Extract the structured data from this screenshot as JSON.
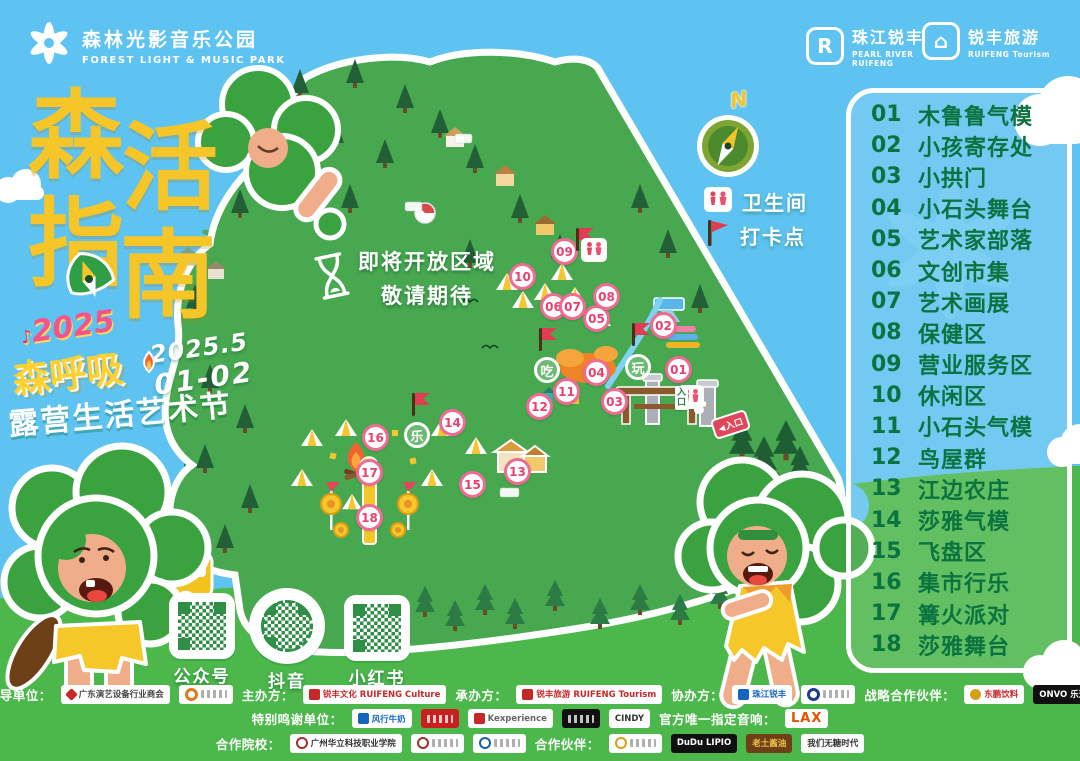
{
  "colors": {
    "sky": "#5ec3f1",
    "grass": "#4cb74b",
    "title_yellow": "#f6c629",
    "legend_green": "#0a7340",
    "marker_pink": "#e8537c"
  },
  "header": {
    "park_logo": {
      "title": "森林光影音乐公园",
      "subtitle": "FOREST LIGHT & MUSIC PARK"
    },
    "brand1": {
      "name": "珠江锐丰",
      "line1": "PEARL RIVER",
      "line2": "RUIFENG"
    },
    "brand2": {
      "name": "锐丰旅游",
      "line1": "RUIFENG Tourism"
    }
  },
  "title_block": {
    "char1": "森",
    "char2": "活",
    "char3": "指",
    "char4": "南",
    "festival_logo": "2025",
    "event_name": "森呼吸",
    "date_top": "2025.5",
    "date_bottom": "01-02",
    "subtitle": "露营生活艺术节"
  },
  "map": {
    "coming_soon_line1": "即将开放区域",
    "coming_soon_line2": "敬请期待",
    "compass_n": "N",
    "map_legend": [
      {
        "icon": "restroom-icon",
        "label": "卫生间"
      },
      {
        "icon": "flag-icon",
        "label": "打卡点"
      }
    ],
    "entrance_sign": "入口",
    "entrance_arrow": "入口",
    "markers": [
      {
        "n": "01",
        "x": 679,
        "y": 370
      },
      {
        "n": "02",
        "x": 664,
        "y": 326
      },
      {
        "n": "03",
        "x": 615,
        "y": 402
      },
      {
        "n": "04",
        "x": 597,
        "y": 373
      },
      {
        "n": "05",
        "x": 597,
        "y": 319
      },
      {
        "n": "06",
        "x": 554,
        "y": 307
      },
      {
        "n": "07",
        "x": 573,
        "y": 307
      },
      {
        "n": "08",
        "x": 607,
        "y": 297
      },
      {
        "n": "09",
        "x": 565,
        "y": 252
      },
      {
        "n": "10",
        "x": 523,
        "y": 277
      },
      {
        "n": "11",
        "x": 567,
        "y": 392
      },
      {
        "n": "12",
        "x": 540,
        "y": 407
      },
      {
        "n": "13",
        "x": 518,
        "y": 472
      },
      {
        "n": "14",
        "x": 453,
        "y": 423
      },
      {
        "n": "15",
        "x": 473,
        "y": 485
      },
      {
        "n": "16",
        "x": 376,
        "y": 438
      },
      {
        "n": "17",
        "x": 370,
        "y": 473
      },
      {
        "n": "18",
        "x": 370,
        "y": 518
      }
    ],
    "badges": [
      {
        "ch": "吃",
        "x": 547,
        "y": 370
      },
      {
        "ch": "玩",
        "x": 638,
        "y": 367
      },
      {
        "ch": "乐",
        "x": 417,
        "y": 435
      }
    ],
    "flags": [
      {
        "x": 577,
        "y": 248
      },
      {
        "x": 633,
        "y": 343
      },
      {
        "x": 540,
        "y": 348
      },
      {
        "x": 413,
        "y": 413
      }
    ],
    "wc": [
      {
        "x": 594,
        "y": 250
      },
      {
        "x": 691,
        "y": 397
      }
    ]
  },
  "legend_panel": {
    "items": [
      {
        "num": "01",
        "label": "木鲁鲁气模"
      },
      {
        "num": "02",
        "label": "小孩寄存处"
      },
      {
        "num": "03",
        "label": "小拱门"
      },
      {
        "num": "04",
        "label": "小石头舞台"
      },
      {
        "num": "05",
        "label": "艺术家部落"
      },
      {
        "num": "06",
        "label": "文创市集"
      },
      {
        "num": "07",
        "label": "艺术画展"
      },
      {
        "num": "08",
        "label": "保健区"
      },
      {
        "num": "09",
        "label": "营业服务区"
      },
      {
        "num": "10",
        "label": "休闲区"
      },
      {
        "num": "11",
        "label": "小石头气模"
      },
      {
        "num": "12",
        "label": "鸟屋群"
      },
      {
        "num": "13",
        "label": "江边农庄"
      },
      {
        "num": "14",
        "label": "莎雅气模"
      },
      {
        "num": "15",
        "label": "飞盘区"
      },
      {
        "num": "16",
        "label": "集市行乐"
      },
      {
        "num": "17",
        "label": "篝火派对"
      },
      {
        "num": "18",
        "label": "莎雅舞台"
      }
    ]
  },
  "qr": {
    "items": [
      {
        "label": "公众号"
      },
      {
        "label": "抖音"
      },
      {
        "label": "小红书"
      }
    ]
  },
  "sponsors": {
    "rows": [
      {
        "groups": [
          {
            "label": "指导单位：",
            "logos": [
              {
                "t": "广东演艺设备行业商会",
                "c": "",
                "i": "red-diamond"
              },
              {
                "t": "",
                "c": "pill-ghost",
                "i": "orange-ring"
              }
            ]
          },
          {
            "label": "主办方：",
            "logos": [
              {
                "t": "锐丰文化 RUIFENG Culture",
                "c": "txt-red",
                "i": "red-square"
              }
            ]
          },
          {
            "label": "承办方：",
            "logos": [
              {
                "t": "锐丰旅游 RUIFENG Tourism",
                "c": "txt-red",
                "i": "red-square"
              }
            ]
          },
          {
            "label": "协办方：",
            "logos": [
              {
                "t": "珠江锐丰",
                "c": "txt-blue",
                "i": "blue-r"
              },
              {
                "t": "",
                "c": "pill-ghost",
                "i": "blue-ring"
              }
            ]
          },
          {
            "label": "战略合作伙伴：",
            "logos": [
              {
                "t": "东鹏饮料",
                "c": "txt-red",
                "i": "gold-badge"
              },
              {
                "t": "ONVO 乐道",
                "c": "pill-black",
                "i": ""
              }
            ]
          }
        ]
      },
      {
        "groups": [
          {
            "label": "特别鸣谢单位：",
            "logos": [
              {
                "t": "风行牛奶",
                "c": "txt-blue",
                "i": "blue-box"
              },
              {
                "t": "",
                "c": "pill-red pill-ghost",
                "i": ""
              },
              {
                "t": "Kexperience",
                "c": "txt-gray",
                "i": "red-r"
              },
              {
                "t": "",
                "c": "pill-black pill-ghost",
                "i": ""
              },
              {
                "t": "CINDY",
                "c": "txt-dark",
                "i": ""
              }
            ]
          },
          {
            "label": "官方唯一指定音响：",
            "logos": [
              {
                "t": "LAX",
                "c": "txt-lax",
                "i": ""
              }
            ]
          }
        ]
      },
      {
        "groups": [
          {
            "label": "合作院校：",
            "logos": [
              {
                "t": "广州华立科技职业学院",
                "c": "txt-dark",
                "i": "crest-red"
              },
              {
                "t": "",
                "c": "pill-ghost",
                "i": "crest-red"
              },
              {
                "t": "",
                "c": "pill-ghost",
                "i": "crest-blue"
              }
            ]
          },
          {
            "label": "合作伙伴：",
            "logos": [
              {
                "t": "",
                "c": "pill-ghost",
                "i": "gold-ring"
              },
              {
                "t": "DuDu LIPIO",
                "c": "pill-black",
                "i": ""
              },
              {
                "t": "老土酱油",
                "c": "pill-brown",
                "i": ""
              },
              {
                "t": "我们无糖时代",
                "c": "txt-dark",
                "i": ""
              }
            ]
          }
        ]
      }
    ]
  }
}
